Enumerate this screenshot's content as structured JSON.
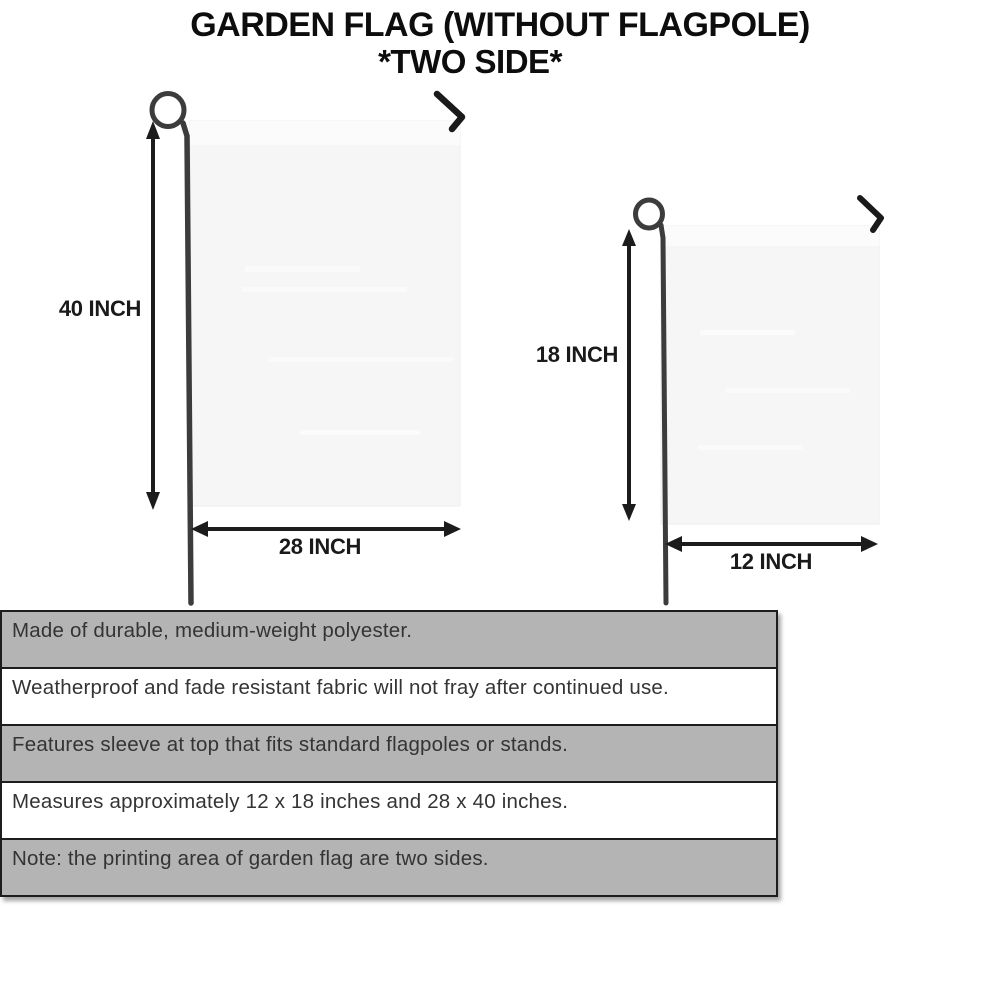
{
  "title": {
    "line1": "GARDEN FLAG (WITHOUT FLAGPOLE)",
    "line2": "*TWO SIDE*"
  },
  "diagrams": {
    "large_flag": {
      "height_label": "40 INCH",
      "width_label": "28 INCH"
    },
    "small_flag": {
      "height_label": "18 INCH",
      "width_label": "12 INCH"
    }
  },
  "features": {
    "rows": [
      {
        "text": "Made of durable, medium-weight polyester."
      },
      {
        "text": "Weatherproof and fade resistant fabric will not fray after continued use."
      },
      {
        "text": "Features sleeve at top that fits standard flagpoles or stands."
      },
      {
        "text": "Measures approximately 12 x 18 inches and 28 x 40 inches."
      },
      {
        "text": "Note: the printing area of garden flag are two sides."
      }
    ]
  },
  "colors": {
    "title_text": "#0d0d0d",
    "dimension_text": "#1a1a1a",
    "feature_text": "#343434",
    "stripe_gray": "#b4b4b4",
    "stripe_white": "#ffffff",
    "stripe_border": "#1d1d1d",
    "flag_fill": "#f6f6f6",
    "flag_sleeve": "#fbfbfb",
    "pole": "#3c3c3c",
    "arrow": "#1c1c1c"
  }
}
